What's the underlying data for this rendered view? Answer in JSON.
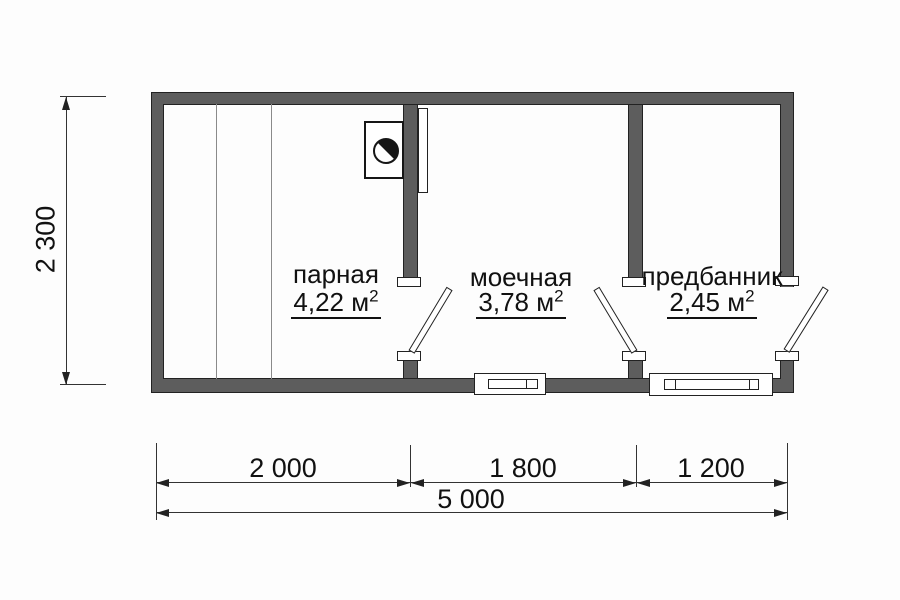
{
  "title": "Bath house floor plan",
  "rooms": [
    {
      "name": "парная",
      "area": "4,22 м",
      "sup": "2"
    },
    {
      "name": "моечная",
      "area": "3,78 м",
      "sup": "2"
    },
    {
      "name": "предбанник",
      "area": "2,45 м",
      "sup": "2"
    }
  ],
  "dimensions": {
    "left_height": "2 300",
    "bottom_segments": [
      "2 000",
      "1 800",
      "1 200"
    ],
    "bottom_total": "5 000"
  },
  "colors": {
    "wall": "#5d5d5d",
    "line": "#222222",
    "text": "#111111"
  }
}
